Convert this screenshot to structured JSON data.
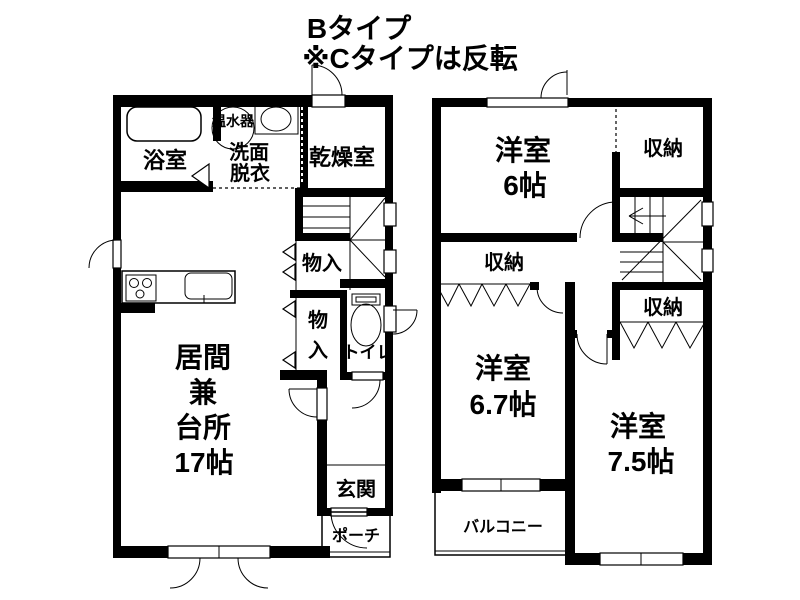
{
  "title": {
    "line1": "Bタイプ",
    "line2": "※Cタイプは反転"
  },
  "floor1": {
    "bathroom": "浴室",
    "water_heater": "温水器",
    "washroom1": "洗面",
    "washroom2": "脱衣",
    "drying_room": "乾燥室",
    "closet_upper": "物入",
    "closet_lower1": "物",
    "closet_lower2": "入",
    "toilet": "トイレ",
    "living1": "居間",
    "living2": "兼",
    "living3": "台所",
    "living4": "17帖",
    "entrance": "玄関",
    "porch": "ポーチ"
  },
  "floor2": {
    "room6_1": "洋室",
    "room6_2": "6帖",
    "closet_top": "収納",
    "closet_mid": "収納",
    "closet_right": "収納",
    "room67_1": "洋室",
    "room67_2": "6.7帖",
    "room75_1": "洋室",
    "room75_2": "7.5帖",
    "balcony": "バルコニー"
  },
  "colors": {
    "wall": "#000000",
    "background": "#ffffff",
    "text": "#000000"
  }
}
